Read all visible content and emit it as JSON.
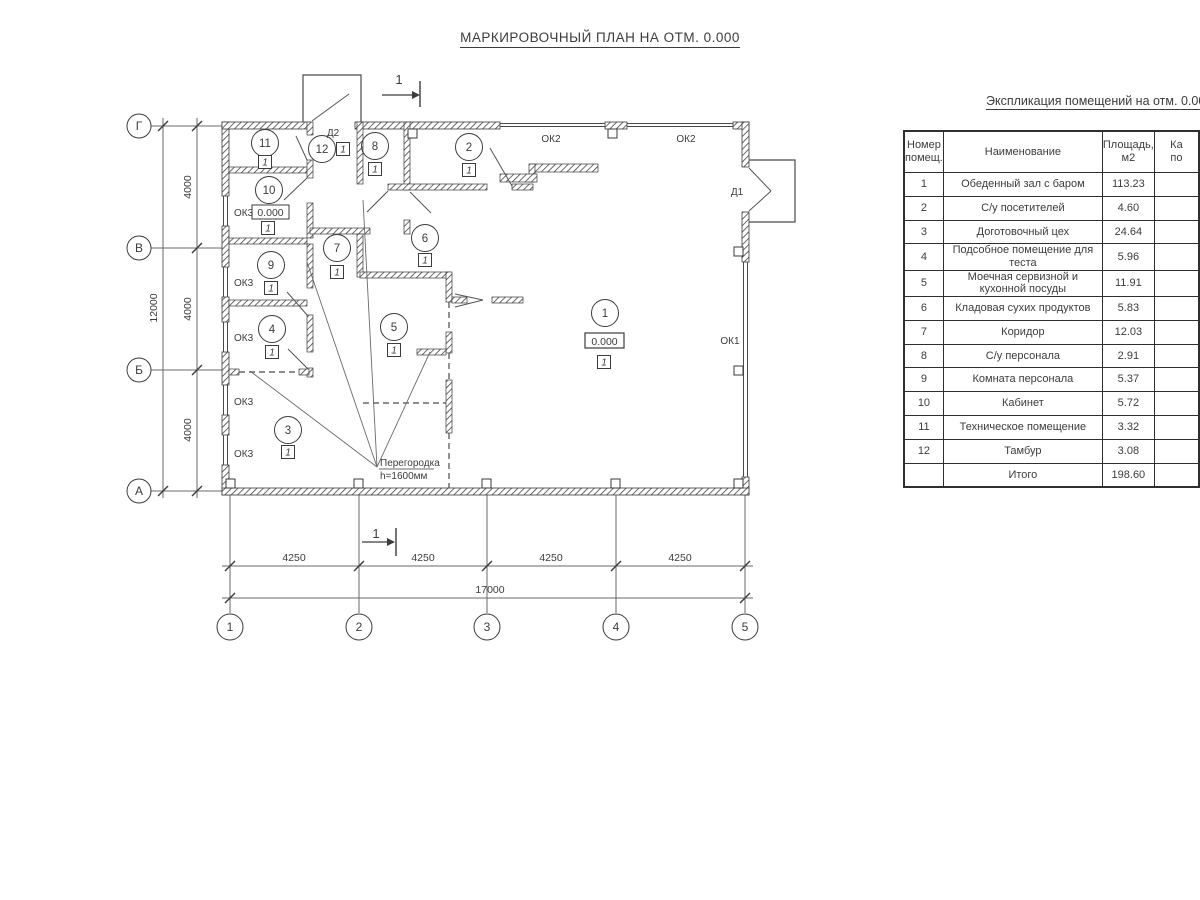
{
  "page": {
    "title": "МАРКИРОВОЧНЫЙ ПЛАН НА ОТМ. 0.000"
  },
  "plan": {
    "section_label": "1",
    "elevation": "0.000",
    "floor_mark": "1",
    "doors": {
      "d1": "Д1",
      "d2": "Д2"
    },
    "windows": {
      "ok1": "ОК1",
      "ok2": "ОК2",
      "ok3": "ОК3"
    },
    "partition_note": {
      "line1": "Перегородка",
      "line2": "h=1600мм"
    },
    "rooms": [
      "1",
      "2",
      "3",
      "4",
      "5",
      "6",
      "7",
      "8",
      "9",
      "10",
      "11",
      "12"
    ],
    "axes": {
      "horizontal": [
        "Г",
        "В",
        "Б",
        "А"
      ],
      "vertical": [
        "1",
        "2",
        "3",
        "4",
        "5"
      ]
    },
    "dimensions": {
      "vertical_segments": [
        "4000",
        "4000",
        "4000"
      ],
      "vertical_total": "12000",
      "horizontal_segments": [
        "4250",
        "4250",
        "4250",
        "4250"
      ],
      "horizontal_total": "17000"
    }
  },
  "schedule": {
    "title": "Экспликация помещений на отм. 0.000",
    "headers": {
      "number_l1": "Номер",
      "number_l2": "помещ.",
      "name": "Наименование",
      "area_l1": "Площадь,",
      "area_l2": "м2",
      "cut_l1": "Ка",
      "cut_l2": "по"
    },
    "rows": [
      {
        "num": "1",
        "name": "Обеденный зал с баром",
        "area": "113.23"
      },
      {
        "num": "2",
        "name": "С/у посетителей",
        "area": "4.60"
      },
      {
        "num": "3",
        "name": "Доготовочный цех",
        "area": "24.64"
      },
      {
        "num": "4",
        "name": "Подсобное помещение для теста",
        "area": "5.96"
      },
      {
        "num": "5",
        "name": "Моечная сервизной и кухонной посуды",
        "area": "11.91"
      },
      {
        "num": "6",
        "name": "Кладовая сухих продуктов",
        "area": "5.83"
      },
      {
        "num": "7",
        "name": "Коридор",
        "area": "12.03"
      },
      {
        "num": "8",
        "name": "С/у персонала",
        "area": "2.91"
      },
      {
        "num": "9",
        "name": "Комната персонала",
        "area": "5.37"
      },
      {
        "num": "10",
        "name": "Кабинет",
        "area": "5.72"
      },
      {
        "num": "11",
        "name": "Техническое помещение",
        "area": "3.32"
      },
      {
        "num": "12",
        "name": "Тамбур",
        "area": "3.08"
      }
    ],
    "total_label": "Итого",
    "total_area": "198.60"
  }
}
